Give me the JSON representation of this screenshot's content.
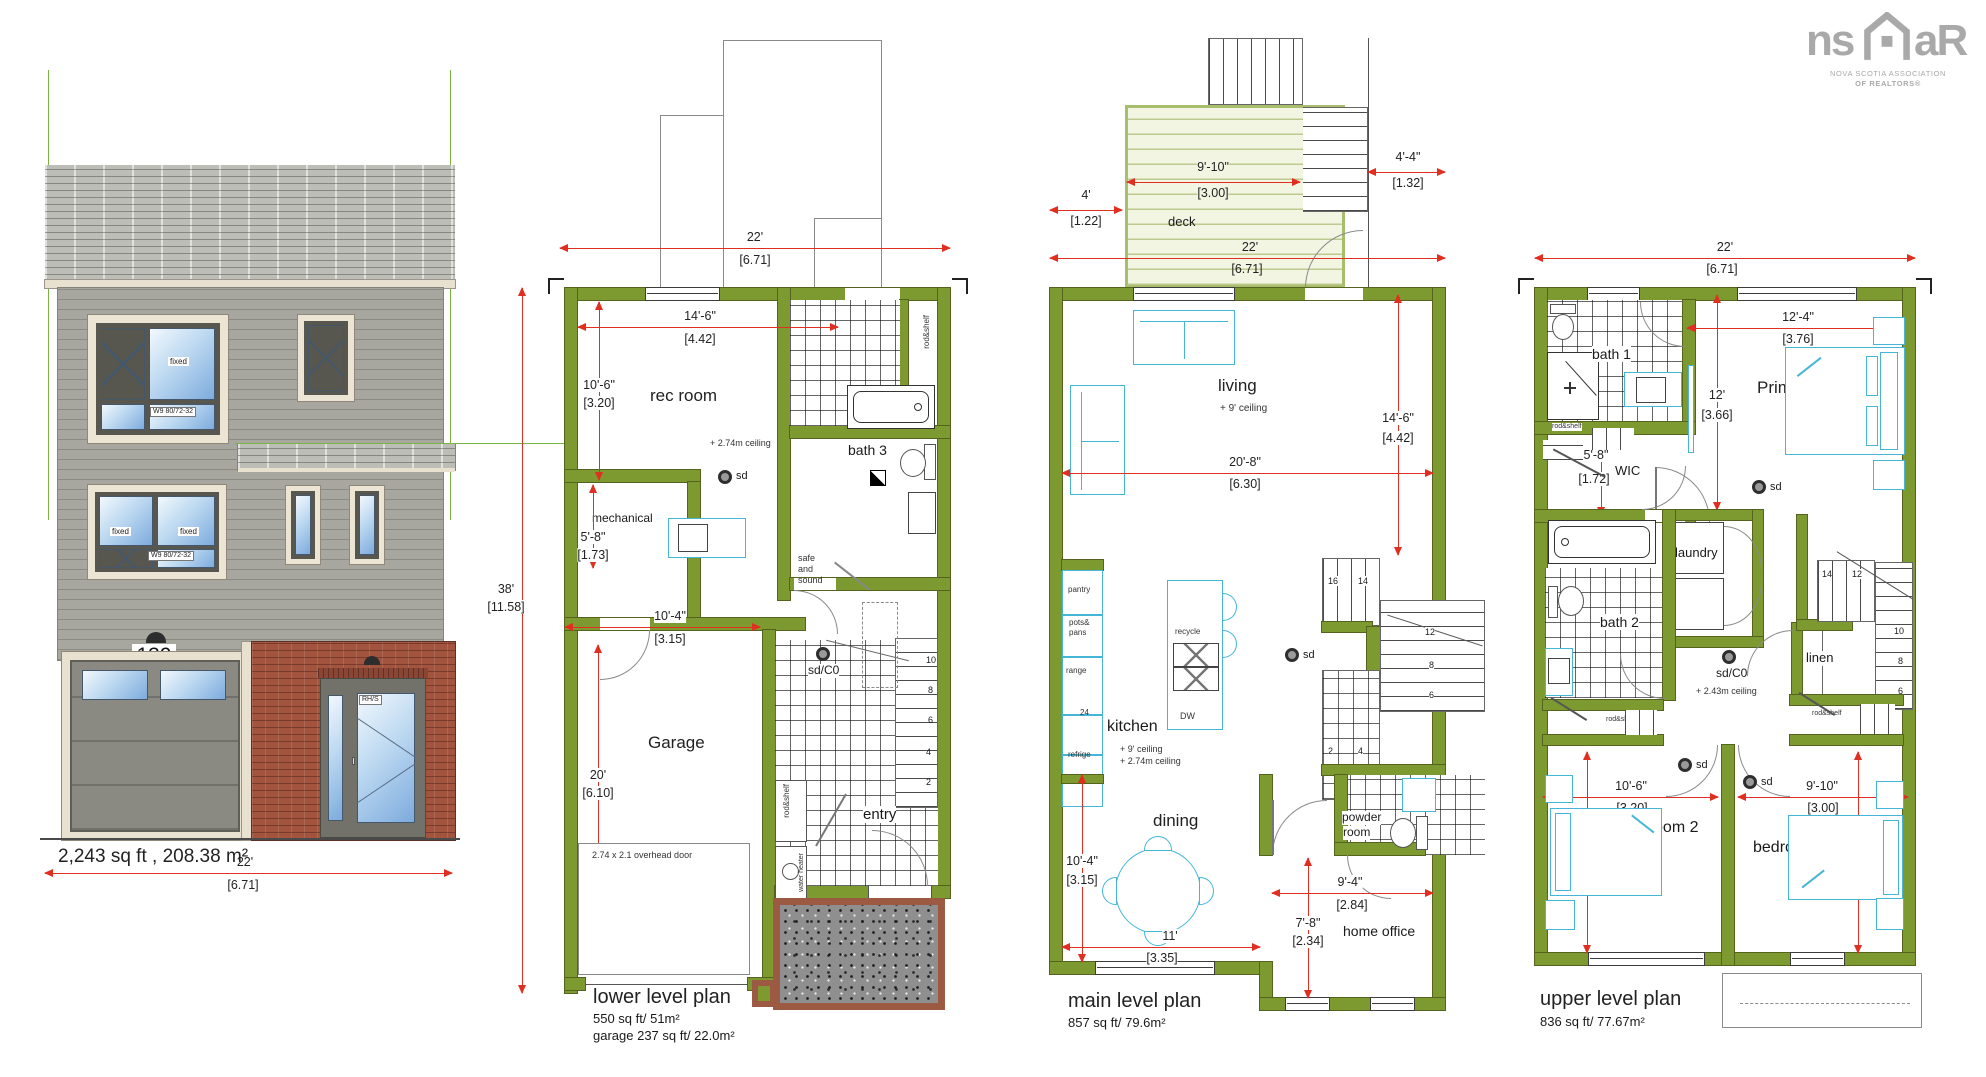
{
  "logo": {
    "ns": "ns",
    "ar": "aR",
    "tag1": "NOVA SCOTIA ASSOCIATION",
    "tag2": "OF REALTORS®"
  },
  "elev": {
    "num": "139",
    "area": "2,243 sq ft , 208.38 m²",
    "fixed": "fixed",
    "wtag": "W9 80/72-32",
    "dtag": "RH/S",
    "dim": {
      "ft": "22'",
      "m": "[6.71]"
    }
  },
  "lower": {
    "title": "lower level plan",
    "area1": "550 sq ft/ 51m²",
    "area2": "garage 237 sq ft/ 22.0m²",
    "rooms": {
      "rec": "rec room",
      "bath3": "bath 3",
      "mech": "mechanical",
      "garage": "Garage",
      "entry": "entry"
    },
    "notes": {
      "ceil": "+ 2.74m ceiling",
      "sd": "sd",
      "sdco": "sd/C0",
      "safe1": "safe",
      "safe2": "and",
      "safe3": "sound",
      "rod": "rod&shelf",
      "water": "water heater",
      "ohdoor": "2.74 x 2.1 overhead door"
    },
    "dims": {
      "w": {
        "ft": "22'",
        "m": "[6.71]"
      },
      "recw": {
        "ft": "14'-6\"",
        "m": "[4.42]"
      },
      "rech": {
        "ft": "10'-6\"",
        "m": "[3.20]"
      },
      "th": {
        "ft": "38'",
        "m": "[11.58]"
      },
      "mech": {
        "ft": "5'-8\"",
        "m": "[1.73]"
      },
      "gw": {
        "ft": "10'-4\"",
        "m": "[3.15]"
      },
      "gh": {
        "ft": "20'",
        "m": "[6.10]"
      }
    },
    "stairs": [
      "10",
      "8",
      "6",
      "4",
      "2"
    ]
  },
  "main": {
    "title": "main level plan",
    "area1": "857 sq ft/ 79.6m²",
    "rooms": {
      "deck": "deck",
      "living": "living",
      "kitchen": "kitchen",
      "dining": "dining",
      "pr1": "powder",
      "pr2": "room",
      "office": "home office"
    },
    "notes": {
      "lc": "+ 9' ceiling",
      "kc1": "+ 9' ceiling",
      "kc2": "+ 2.74m ceiling",
      "sd": "sd",
      "pantry": "pantry",
      "pots1": "pots&",
      "pots2": "pans",
      "range": "range",
      "n24": "24",
      "refrige": "refrige",
      "recycle": "recycle",
      "dw": "DW"
    },
    "dims": {
      "deckw": {
        "ft": "9'-10\"",
        "m": "[3.00]"
      },
      "deckr": {
        "ft": "4'-4\"",
        "m": "[1.32]"
      },
      "deckl": {
        "ft": "4'",
        "m": "[1.22]"
      },
      "w": {
        "ft": "22'",
        "m": "[6.71]"
      },
      "lh": {
        "ft": "14'-6\"",
        "m": "[4.42]"
      },
      "lw": {
        "ft": "20'-8\"",
        "m": "[6.30]"
      },
      "dh": {
        "ft": "10'-4\"",
        "m": "[3.15]"
      },
      "dwid": {
        "ft": "11'",
        "m": "[3.35]"
      },
      "ow": {
        "ft": "9'-4\"",
        "m": "[2.84]"
      },
      "oh": {
        "ft": "7'-8\"",
        "m": "[2.34]"
      }
    },
    "st": [
      "16",
      "14"
    ],
    "sr": [
      "12",
      "8",
      "6"
    ],
    "sb": [
      "2",
      "4"
    ]
  },
  "upper": {
    "title": "upper level plan",
    "area1": "836 sq ft/ 77.67m²",
    "rooms": {
      "bath1": "bath 1",
      "primary": "Primary",
      "wic": "WIC",
      "laundry": "laundry",
      "bath2": "bath 2",
      "linen": "linen",
      "bed2": "bedroom 2",
      "bed3": "bedroom 3"
    },
    "notes": {
      "sd": "sd",
      "sdco": "sd/C0",
      "ceil": "+ 2.43m ceiling",
      "rod": "rod&shelf"
    },
    "dims": {
      "w": {
        "ft": "22'",
        "m": "[6.71]"
      },
      "pw": {
        "ft": "12'-4\"",
        "m": "[3.76]"
      },
      "ph": {
        "ft": "12'",
        "m": "[3.66]"
      },
      "wic": {
        "ft": "5'-8\"",
        "m": "[1.72]"
      },
      "b2w": {
        "ft": "10'-6\"",
        "m": "[3.20]"
      },
      "b2h": {
        "ft": "12'",
        "m": "[3.66]"
      },
      "b3w": {
        "ft": "9'-10\"",
        "m": "[3.00]"
      },
      "b3h": {
        "ft": "12'",
        "m": "[3.66]"
      }
    },
    "st": [
      "14",
      "12"
    ],
    "sr": [
      "10",
      "8",
      "6"
    ]
  }
}
